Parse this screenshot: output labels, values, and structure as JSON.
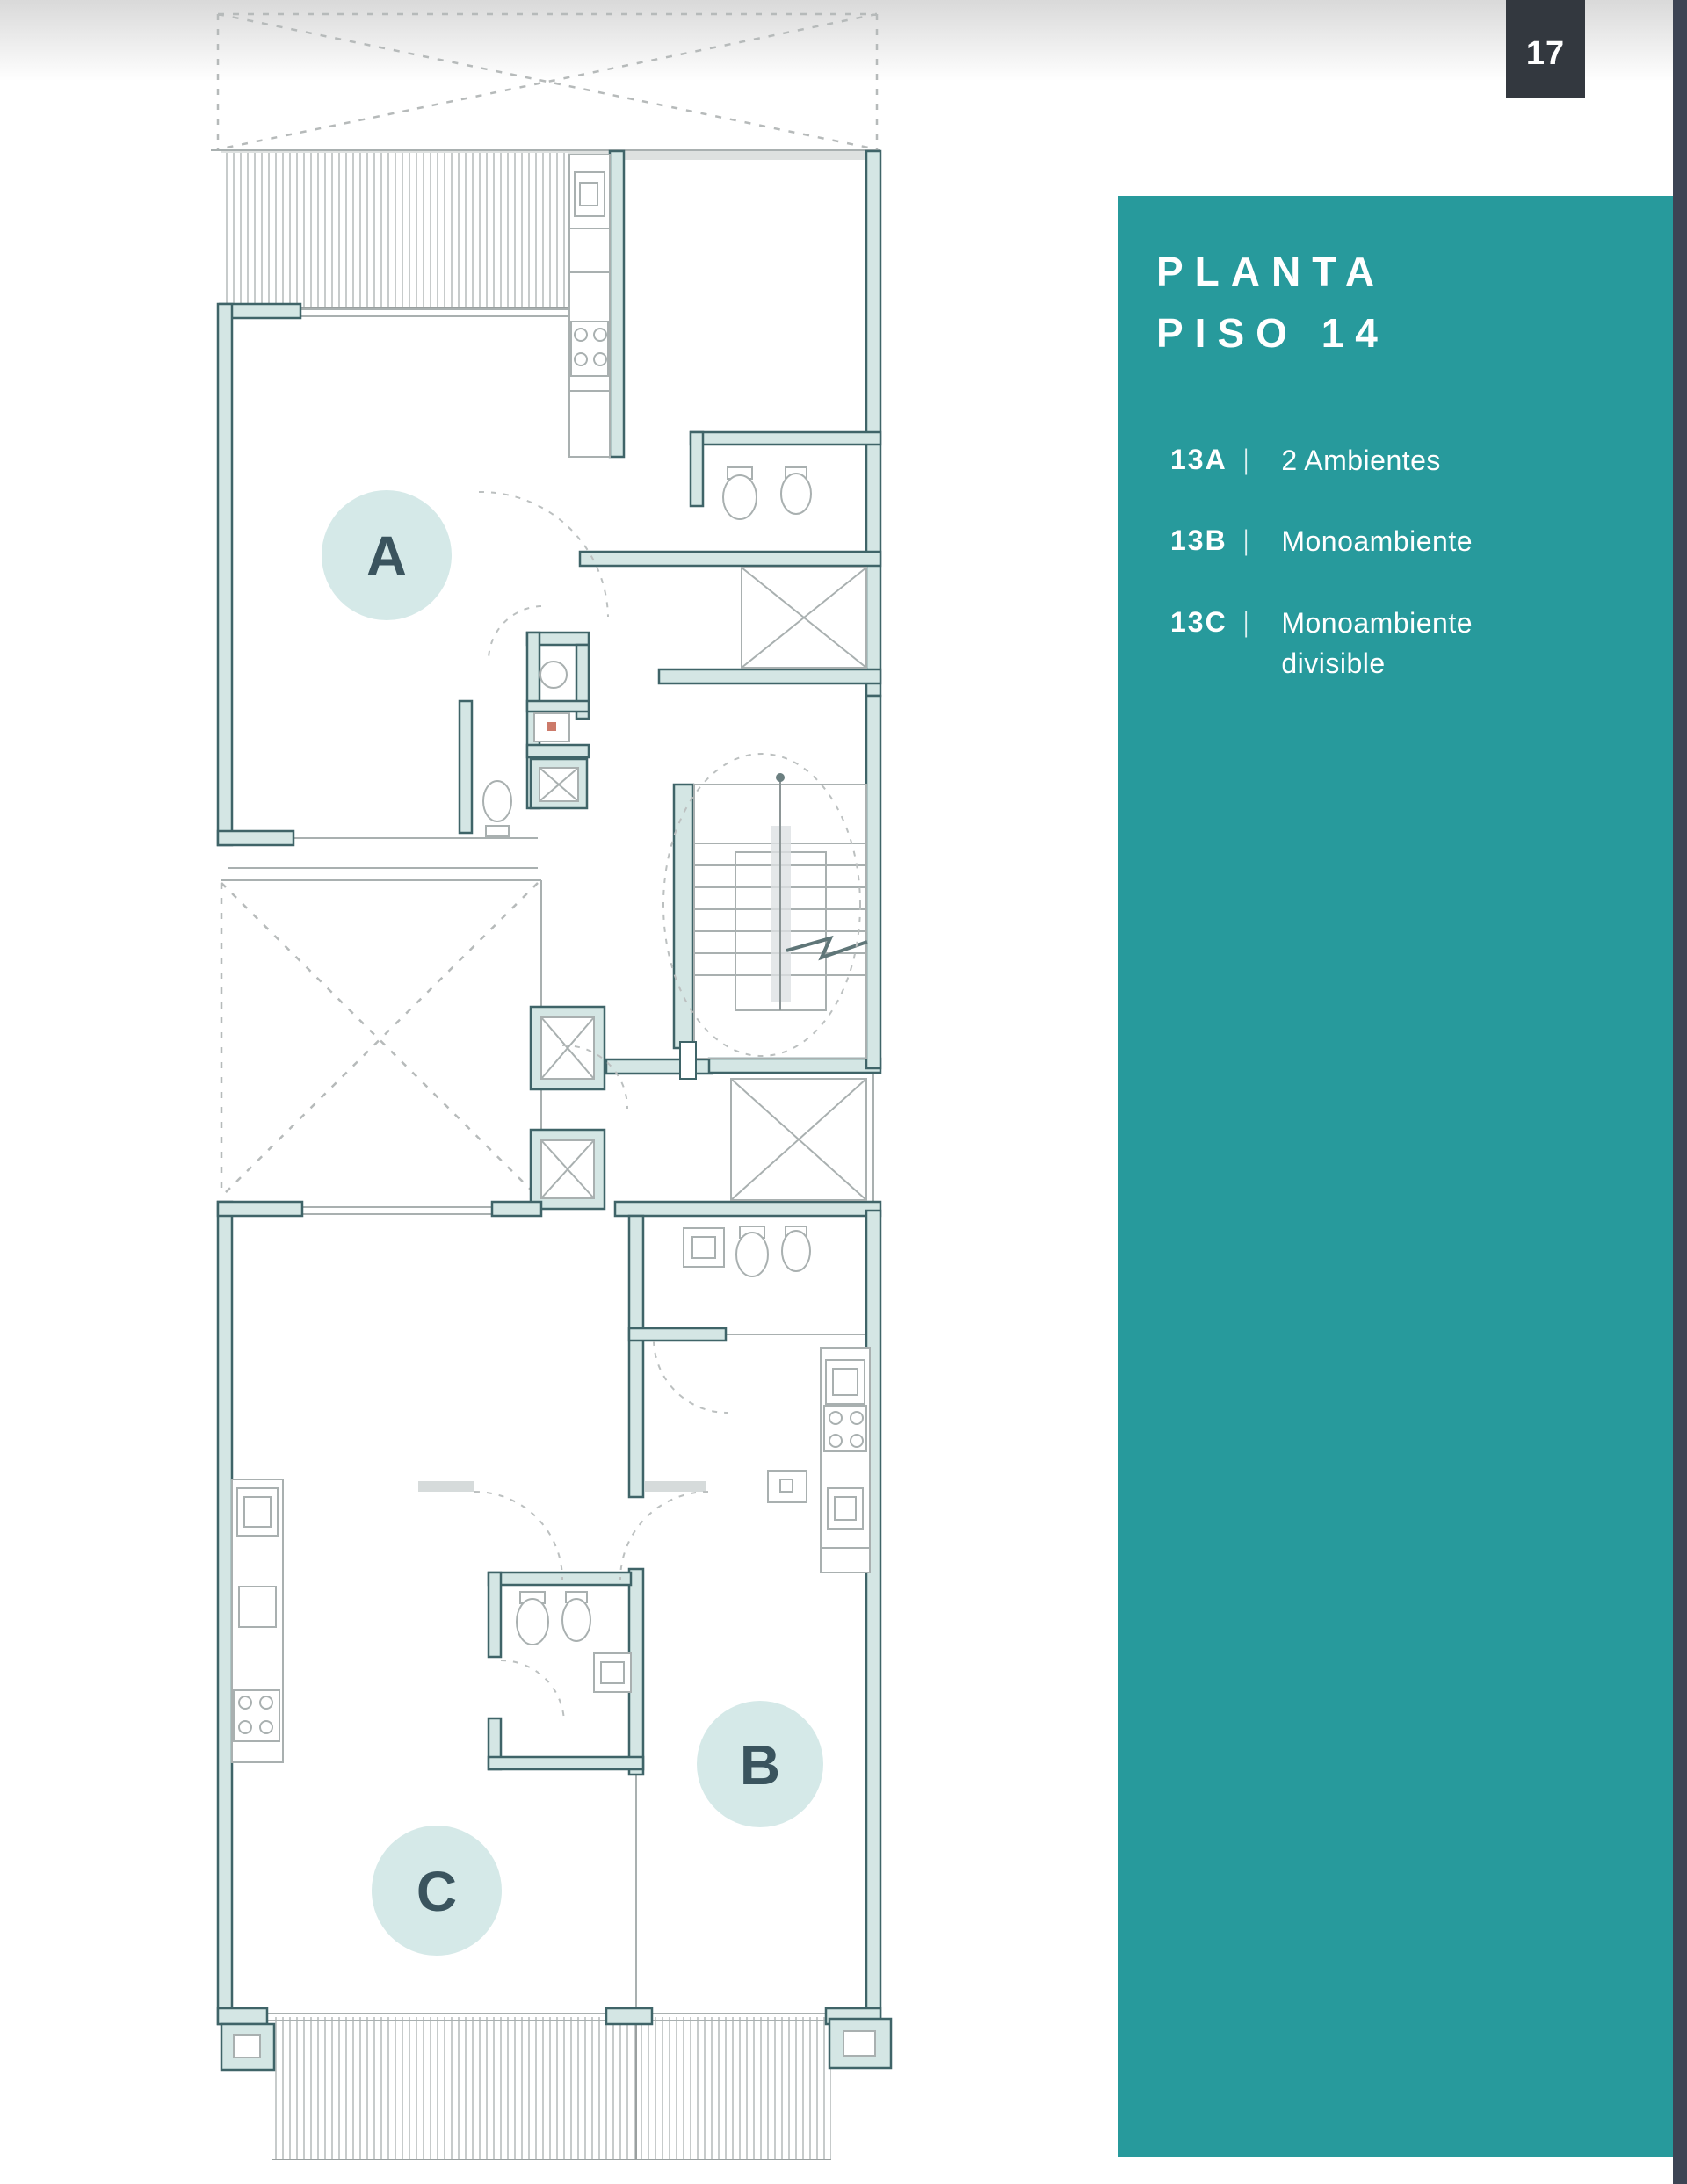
{
  "colors": {
    "teal_panel": "#279a9c",
    "edge_bar": "#3d4454",
    "badge_bg": "#33383f",
    "badge_text": "#ffffff",
    "panel_text": "#ffffff",
    "wall_stroke": "#3f6468",
    "wall_fill": "#d4e6e4",
    "thin_line": "#a9b0b0",
    "dash_line": "#b6baba",
    "label_circle": "#d5e9e8",
    "label_letter": "#3a545e"
  },
  "badge": {
    "page_number": "17"
  },
  "panel": {
    "title_line1": "PLANTA",
    "title_line2": "PISO 14",
    "units": [
      {
        "code": "13A",
        "separator": "|",
        "description": "2 Ambientes"
      },
      {
        "code": "13B",
        "separator": "|",
        "description": "Monoambiente"
      },
      {
        "code": "13C",
        "separator": "|",
        "description": "Monoambiente divisible"
      }
    ]
  },
  "floorplan": {
    "unit_labels": [
      {
        "label": "A"
      },
      {
        "label": "B"
      },
      {
        "label": "C"
      }
    ]
  }
}
